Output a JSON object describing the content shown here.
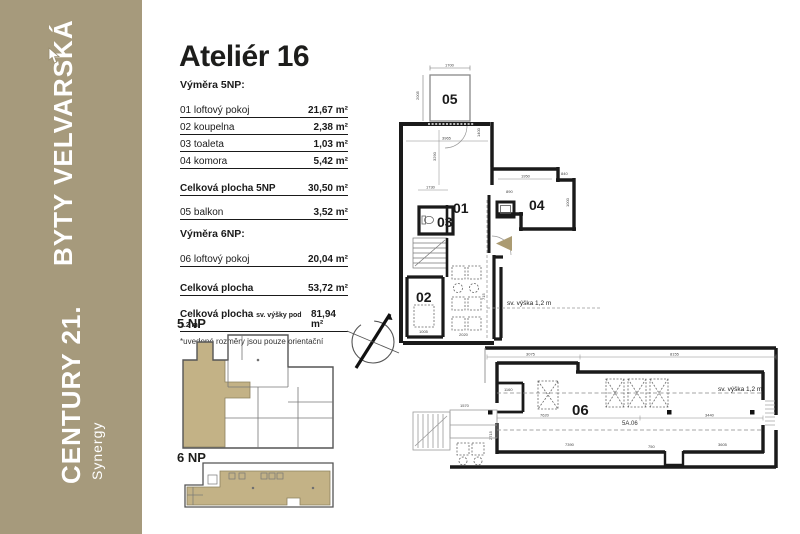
{
  "sidebar": {
    "bg": "#a69a7c",
    "project": "BYTY VELVARSKÁ",
    "brand": "CENTURY 21.",
    "brand_sub": "Synergy"
  },
  "header": {
    "title": "Ateliér 16"
  },
  "areas": {
    "section1_heading": "Výměra 5NP:",
    "rows_5np": [
      {
        "label": "01 loftový pokoj",
        "value": "21,67 m²"
      },
      {
        "label": "02 koupelna",
        "value": "2,38 m²"
      },
      {
        "label": "03 toaleta",
        "value": "1,03 m²"
      },
      {
        "label": "04 komora",
        "value": "5,42 m²"
      }
    ],
    "total_5np": {
      "label": "Celková plocha 5NP",
      "value": "30,50 m²"
    },
    "balcony_row": {
      "label": "05 balkon",
      "value": "3,52 m²"
    },
    "section2_heading": "Výměra 6NP:",
    "rows_6np": [
      {
        "label": "06 loftový pokoj",
        "value": "20,04 m²"
      }
    ],
    "total": {
      "label": "Celková plocha",
      "value": "53,72 m²"
    },
    "total_with_low": {
      "label": "Celková plocha",
      "label_small": "sv. výšky pod 1.2 m",
      "value": "81,94 m²"
    },
    "note": "*uvedené rozměry jsou pouze orientační"
  },
  "miniplans": {
    "label_5np": "5 NP",
    "label_6np": "6 NP"
  },
  "plan_5np": {
    "balcony_label": "05",
    "room_01": "01",
    "room_02": "02",
    "room_03": "03",
    "room_04": "04",
    "height_note": "sv. výška 1,2 m",
    "dims": [
      "1700",
      "2005",
      "3965",
      "1400",
      "3290",
      "1730",
      "1950",
      "890",
      "840",
      "1000",
      "2020",
      "1005",
      "715"
    ]
  },
  "plan_6np": {
    "room_06": "06",
    "unit_code": "5A.06",
    "height_note": "sv. výška 1,2 m",
    "dims": [
      "3075",
      "8155",
      "1160",
      "7620",
      "3440",
      "750",
      "7390",
      "3605",
      "1570",
      "2715"
    ]
  },
  "colors": {
    "accent_tan": "#a69a7c",
    "plan_fill": "#c3b286",
    "arrow_fill": "#ab9b72",
    "wall": "#1a1a1a"
  }
}
